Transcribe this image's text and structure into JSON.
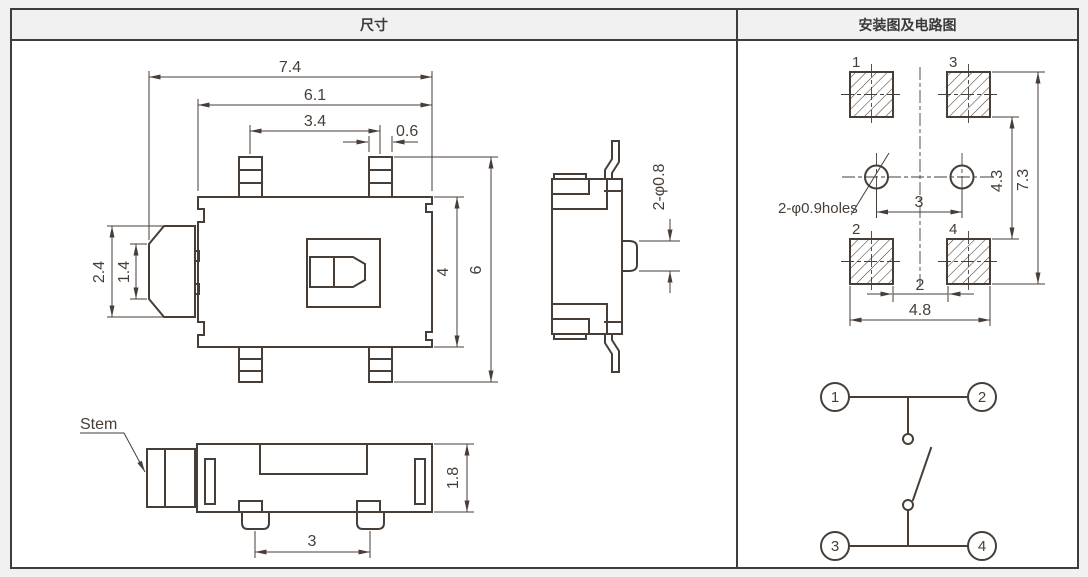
{
  "header": {
    "left_title": "尺寸",
    "right_title": "安装图及电路图"
  },
  "front_view": {
    "overall_width": "7.4",
    "body_width": "6.1",
    "terminal_pitch": "3.4",
    "terminal_width": "0.6",
    "stem_width": "2.4",
    "stem_tip": "1.4",
    "body_height": "4",
    "overall_height": "6"
  },
  "side_view": {
    "bump_note": "2-φ0.8"
  },
  "bottom_view": {
    "stem_label": "Stem",
    "thickness": "1.8",
    "foot_pitch": "3"
  },
  "mounting": {
    "pad1": "1",
    "pad2": "2",
    "pad3": "3",
    "pad4": "4",
    "holes_note": "2-φ0.9holes",
    "hole_pitch": "3",
    "pad_span_inner_v": "4.3",
    "pad_span_outer_v": "7.3",
    "pad_gap_h": "2",
    "pad_span_outer_h": "4.8"
  },
  "circuit": {
    "t1": "1",
    "t2": "2",
    "t3": "3",
    "t4": "4"
  },
  "colors": {
    "line": "#473e38",
    "border": "#3d3d3d",
    "header_bg": "#f1f1f1",
    "page_bg": "#f1f1f1",
    "sheet_bg": "#ffffff"
  }
}
